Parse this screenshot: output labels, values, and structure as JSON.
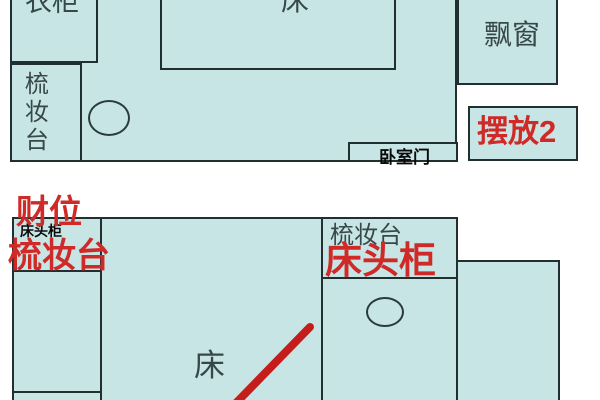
{
  "colors": {
    "room_fill": "#c7e5e4",
    "outline": "#212f31",
    "annotation_red": "#cf2a28",
    "label_dark": "#37474a"
  },
  "plan_top": {
    "wardrobe_label": "衣柜",
    "bed_label": "床",
    "dresser_label_vertical": "梳妆台",
    "bay_window_label": "飘窗",
    "door_label": "卧室门",
    "placement_badge_label": "摆放2"
  },
  "plan_bottom": {
    "wealth_spot_label": "财位",
    "bedside_cabinet_small_label": "床头柜",
    "dresser_red_label": "梳妆台",
    "dresser_black_label": "梳妆台",
    "bedside_cabinet_red_label": "床头柜",
    "bed_label": "床"
  }
}
